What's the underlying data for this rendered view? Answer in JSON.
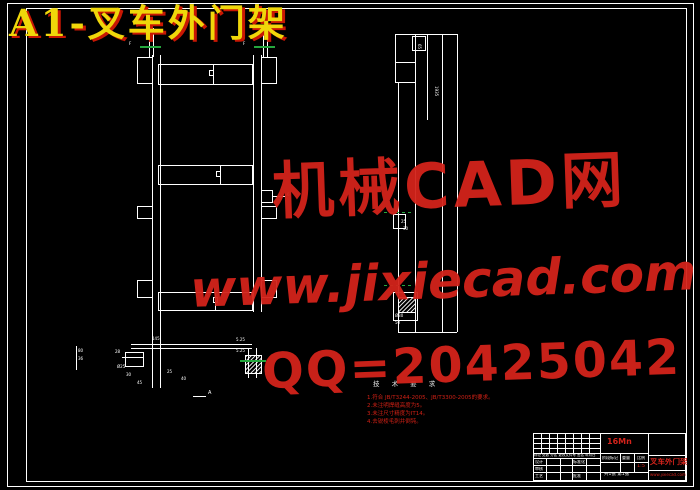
{
  "banner": {
    "text": "A1-叉车外门架"
  },
  "watermarks": {
    "brand": "机械CAD网",
    "site": "www.jixiecad.com",
    "qq": "QQ=20425042",
    "color": "#d3231b"
  },
  "colors": {
    "background": "#000000",
    "line": "#ffffff",
    "section_mark_green": "#25a73e",
    "banner_yellow": "#f0d70a",
    "banner_shadow_red": "#c81703"
  },
  "tech_requirements": {
    "heading": "技 术 要 求",
    "items": [
      "1.符合 JB/T3244-2005、JB/T3300-2005的要求。",
      "2.未注明焊缝高度为5。",
      "3.未注尺寸精度为IT14。",
      "4.去锐棱毛刺并倒钝。"
    ]
  },
  "dims": [
    "F",
    "F",
    "145",
    "80",
    "36",
    "28",
    "Ø25",
    "30",
    "45",
    "25",
    "40",
    "5.25",
    "5.25",
    "A",
    "6",
    "65",
    "1935",
    "25",
    "30",
    "Ø30",
    "50"
  ],
  "title_block": {
    "material": "16Mn",
    "part_name": "叉车外门架",
    "site": "www.jixiecad.com",
    "rev_header": "标记 处数 分区 更改文件号 签名 年月日",
    "design": "设计",
    "standard": "标准化",
    "audit": "审核",
    "process": "工艺",
    "approve": "批准",
    "stage": "阶段标记",
    "weight": "重量",
    "scale": "比例",
    "scale_value": "1:5",
    "sheet": "共1张 第1张"
  }
}
